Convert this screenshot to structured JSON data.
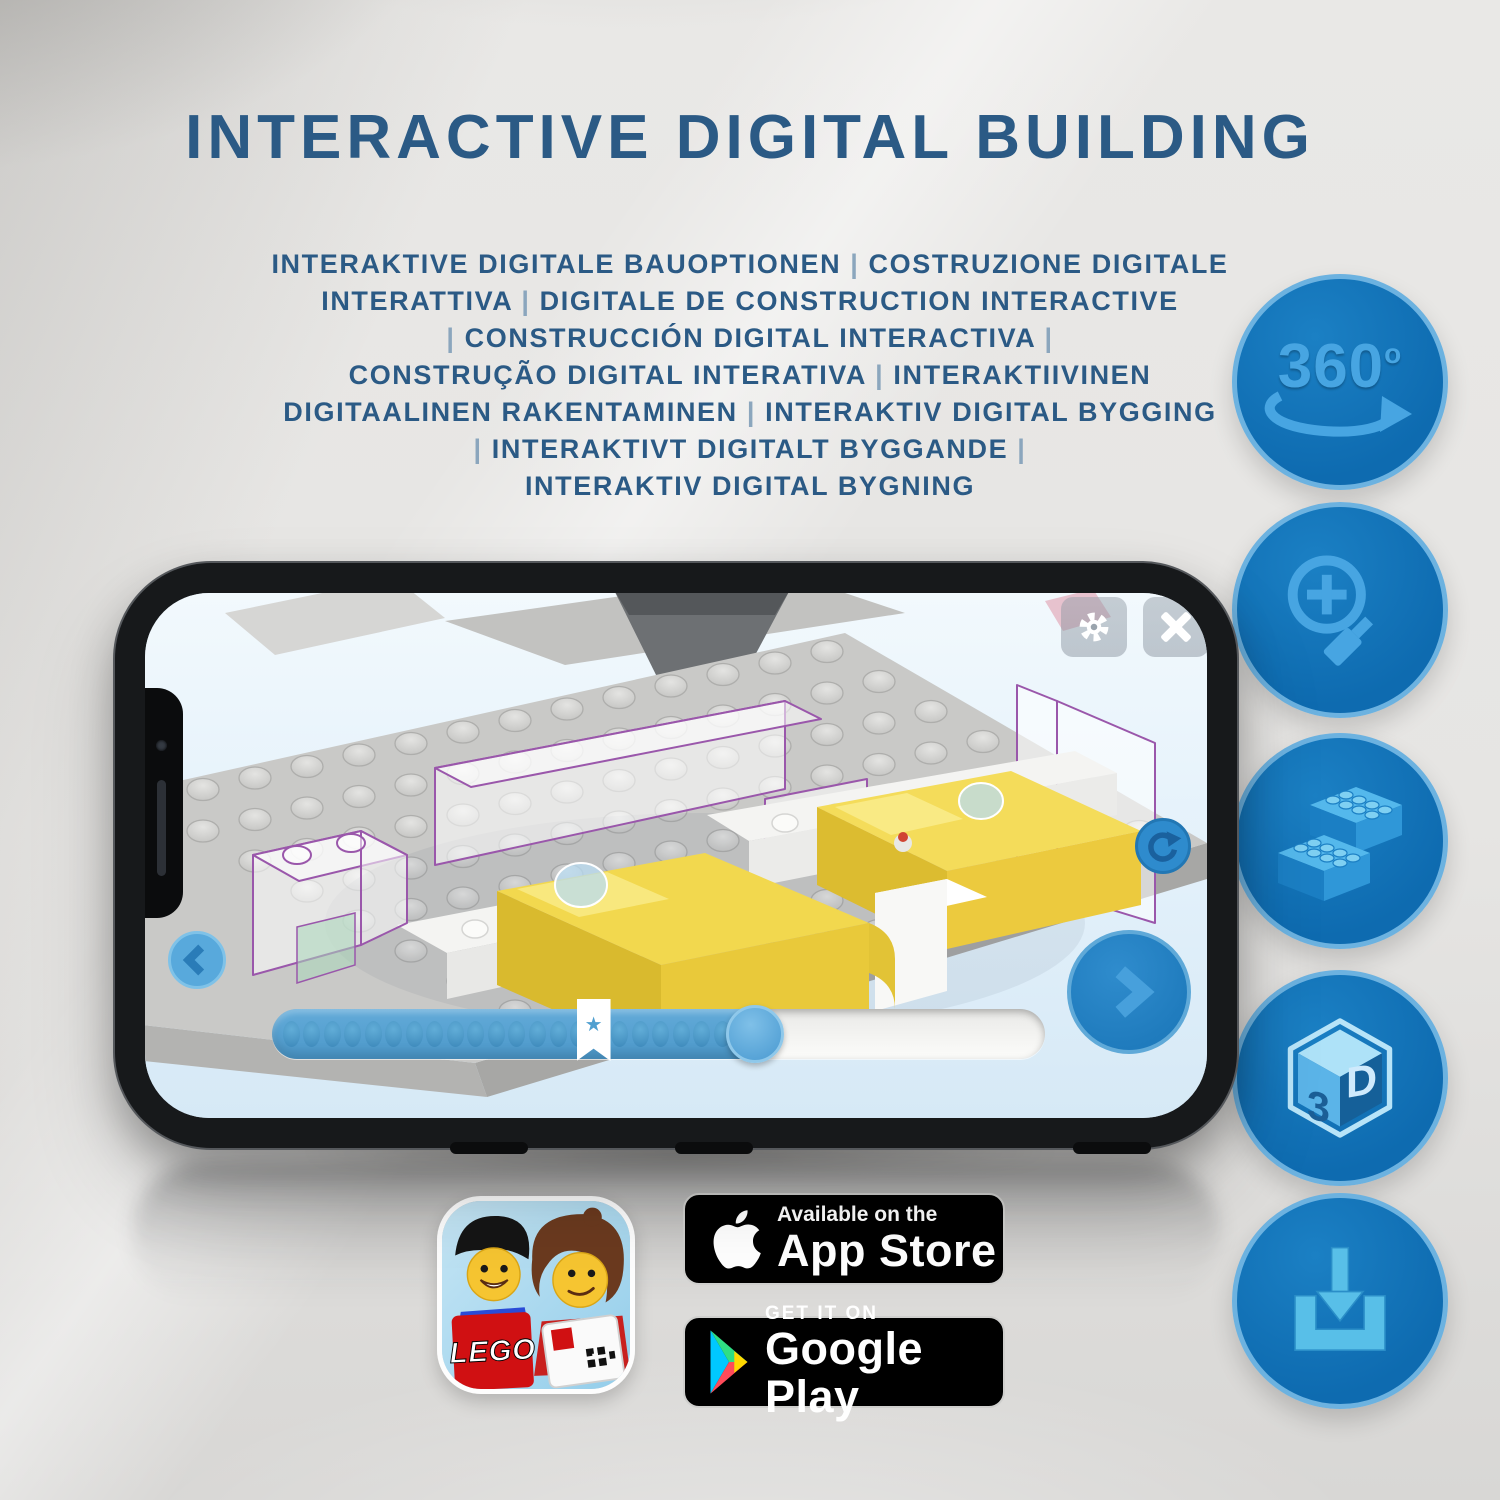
{
  "header": {
    "title": "INTERACTIVE DIGITAL BUILDING",
    "subtitle_lines": [
      "INTERAKTIVE DIGITALE BAUOPTIONEN | COSTRUZIONE DIGITALE",
      "INTERATTIVA | DIGITALE DE CONSTRUCTION INTERACTIVE",
      "| CONSTRUCCIÓN DIGITAL INTERACTIVA |",
      "CONSTRUÇÃO DIGITAL INTERATIVA | INTERAKTIIVINEN",
      "DIGITAALINEN RAKENTAMINEN | INTERAKTIV DIGITAL BYGGING",
      "| INTERAKTIVT DIGITALT BYGGANDE |",
      "INTERAKTIV DIGITAL BYGNING"
    ]
  },
  "feature_badges": {
    "rotation": {
      "label": "360",
      "sup": "o",
      "icon": "360-rotation-arrow-icon"
    },
    "zoom": {
      "icon": "magnifier-zoom-in-icon"
    },
    "bricks": {
      "icon": "lego-bricks-icon"
    },
    "cube3d": {
      "face_left": "3",
      "face_right": "D",
      "icon": "3d-cube-icon"
    },
    "download": {
      "icon": "download-tray-icon"
    }
  },
  "phone_app": {
    "toolbar": {
      "settings_icon": "gear-icon",
      "close_icon": "close-x-icon"
    },
    "controls": {
      "rotate_icon": "rotate-refresh-icon",
      "back_icon": "chevron-left-icon",
      "next_icon": "chevron-right-icon"
    },
    "progress": {
      "percent": 62.5,
      "star_pct": 41.6,
      "dot_count": 23
    }
  },
  "store": {
    "app_icon": {
      "brand": "LEGO",
      "icon": "lego-building-instructions-app-icon"
    },
    "app_store": {
      "line1": "Available on the",
      "line2": "App Store",
      "icon": "apple-logo-icon"
    },
    "google_play": {
      "line1": "GET IT ON",
      "line2": "Google Play",
      "icon": "google-play-triangle-icon"
    }
  },
  "colors": {
    "heading": "#2b5a85",
    "badge_fill": "#0f6bb0",
    "badge_ring": "#6cb2e0",
    "badge_glyph": "#47a5e2",
    "screen_bg": "#ddeefb",
    "brick_yellow": "#f2d84e",
    "outline_purple": "#9a57ab",
    "progress_fill": "#4f9fd0",
    "store_badge_bg": "#000000"
  }
}
